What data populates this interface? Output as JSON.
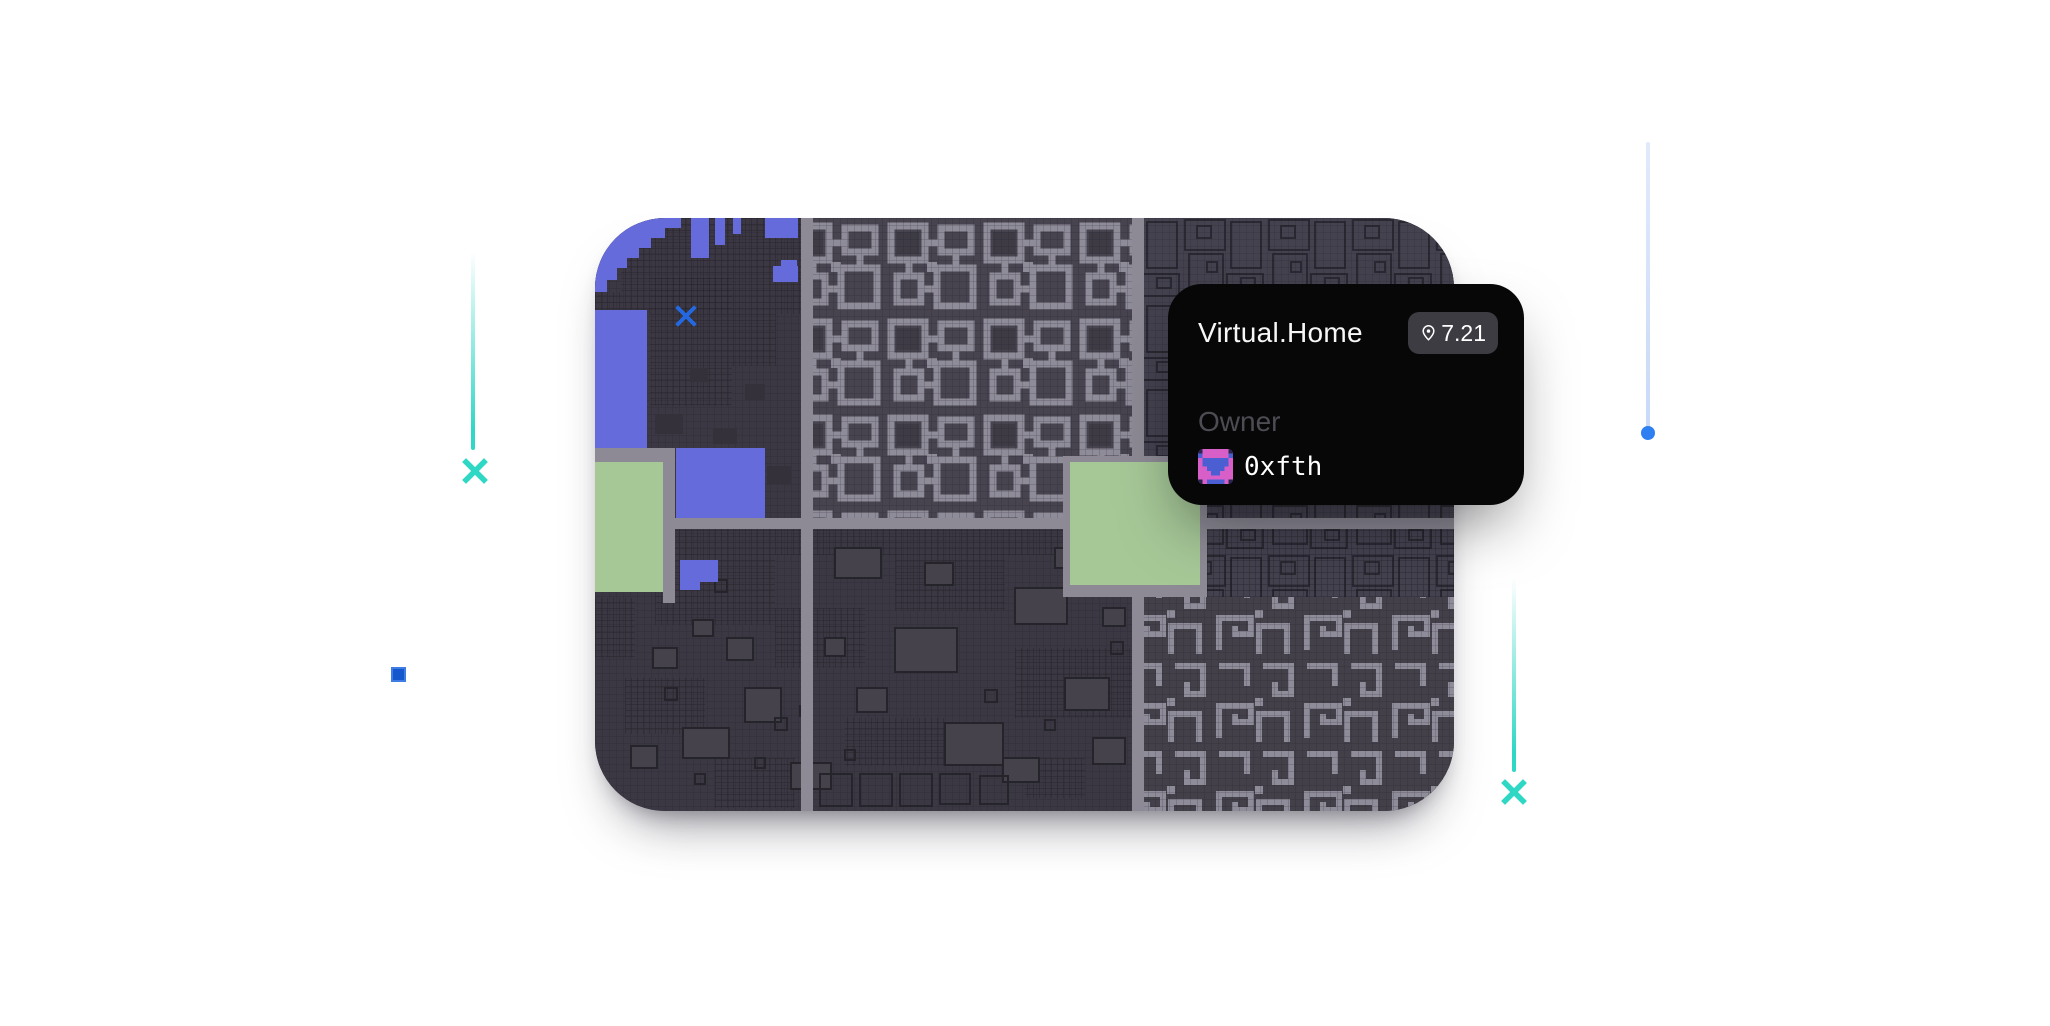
{
  "theme": {
    "page-bg": "#ffffff",
    "teal": "#2fd7c5",
    "dot-blue": "#2e7ff1",
    "square-blue": "#1557cd",
    "square-blue-border": "#3f7de5",
    "line-blue": "#c9daf7",
    "map-base": "#3b3843",
    "map-road": "#8d8a95",
    "map-block": "#474450",
    "map-path": "#8f8c99",
    "map-outline": "#2a2831",
    "map-blue": "#666bdb",
    "map-green": "#a6c897",
    "marker-blue": "#2468e0",
    "card-bg": "#070708",
    "badge-bg": "#3d3c42",
    "owner-gray": "#4e4c53",
    "text-white": "#f7f7f8",
    "avatar-pink": "#d95fc8",
    "avatar-blue": "#4b5fd3"
  },
  "tooltip": {
    "title": "Virtual.Home",
    "badge_value": "7.21",
    "badge_icon": "location-pin-icon",
    "owner_label": "Owner",
    "owner_name": "0xfth"
  },
  "map": {
    "name": "virtual-land-map",
    "selected_marker": "x-marker",
    "parcel_colors": {
      "water": "#666bdb",
      "park": "#a6c897",
      "road": "#8d8a95"
    }
  },
  "decorations": [
    "teal-x-left",
    "teal-x-bottom-right",
    "blue-dot-line",
    "blue-square"
  ]
}
